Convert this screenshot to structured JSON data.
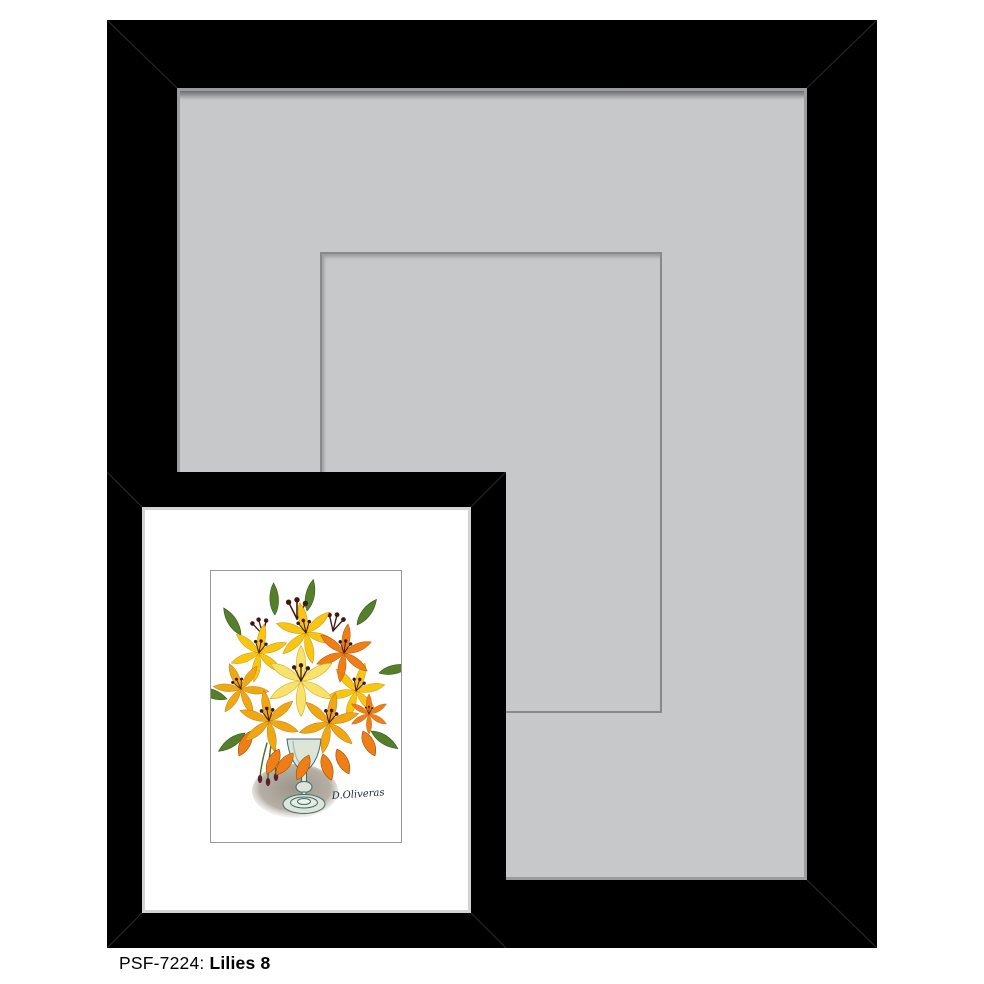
{
  "caption": {
    "code": "PSF-7224:",
    "title": "Lilies 8"
  },
  "large_frame": {
    "frame_color": "#000000",
    "mat_color": "#c7c8ca",
    "mat_edge_color": "#9a9c9f",
    "opening_line_color": "#87898c"
  },
  "framed_print": {
    "frame_color": "#000000",
    "lip_color": "#d2d3d4",
    "mat_color": "#ffffff",
    "art_border_color": "#96989a",
    "signature": "D.Oliveras",
    "palette": {
      "lily_yellow": "#F7C613",
      "lily_golden": "#F0A714",
      "lily_pale": "#F8E26B",
      "lily_orange": "#EE7F16",
      "leaf_green": "#577F2B",
      "stamen_brown": "#40180E",
      "glass": "#DCE5D8",
      "glass_line": "#3F6A6B",
      "shadow": "#A89F93"
    }
  }
}
